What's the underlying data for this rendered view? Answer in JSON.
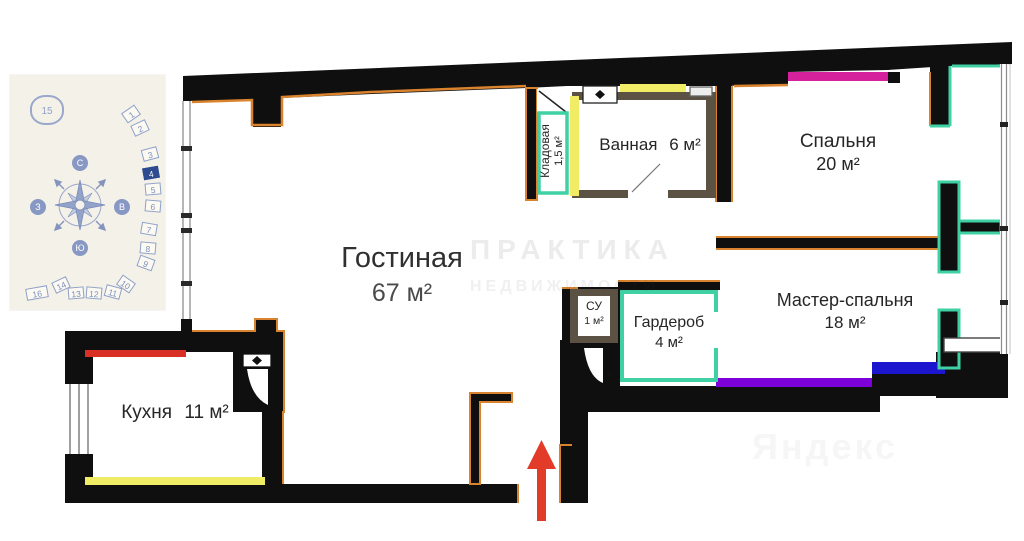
{
  "plan": {
    "rooms": {
      "living": {
        "name": "Гостиная",
        "area": "67 м²"
      },
      "kitchen": {
        "name": "Кухня",
        "area": "11 м²"
      },
      "bathroom": {
        "name": "Ванная",
        "area": "6 м²"
      },
      "storage": {
        "name": "Кладовая",
        "area": "1,5 м²"
      },
      "bedroom": {
        "name": "Спальня",
        "area": "20 м²"
      },
      "master": {
        "name": "Мастер-спальня",
        "area": "18 м²"
      },
      "wardrobe": {
        "name": "Гардероб",
        "area": "4 м²"
      },
      "wc": {
        "name": "СУ",
        "area": "1 м²"
      }
    },
    "colors": {
      "wall": "#0f0f0f",
      "accent_orange": "#d9832e",
      "accent_teal": "#3fd0a4",
      "accent_yellow": "#f0ec66",
      "accent_red": "#d93025",
      "accent_pink": "#d6219c",
      "accent_purple": "#7d00d9",
      "accent_blue": "#1c17cf",
      "bathroom_wall": "#5c5243",
      "entrance_arrow": "#e23b2a"
    }
  },
  "site_plan": {
    "buildings": [
      "1",
      "2",
      "3",
      "4",
      "5",
      "6",
      "7",
      "8",
      "9",
      "10",
      "11",
      "12",
      "13",
      "14",
      "15",
      "16"
    ],
    "highlighted": "4",
    "compass": {
      "n": "С",
      "s": "Ю",
      "w": "З",
      "e": "В"
    }
  },
  "watermarks": {
    "center_line1": "ПРАКТИКА",
    "center_line2": "НЕДВИЖИМОСТИ",
    "corner": "Яндекс"
  }
}
